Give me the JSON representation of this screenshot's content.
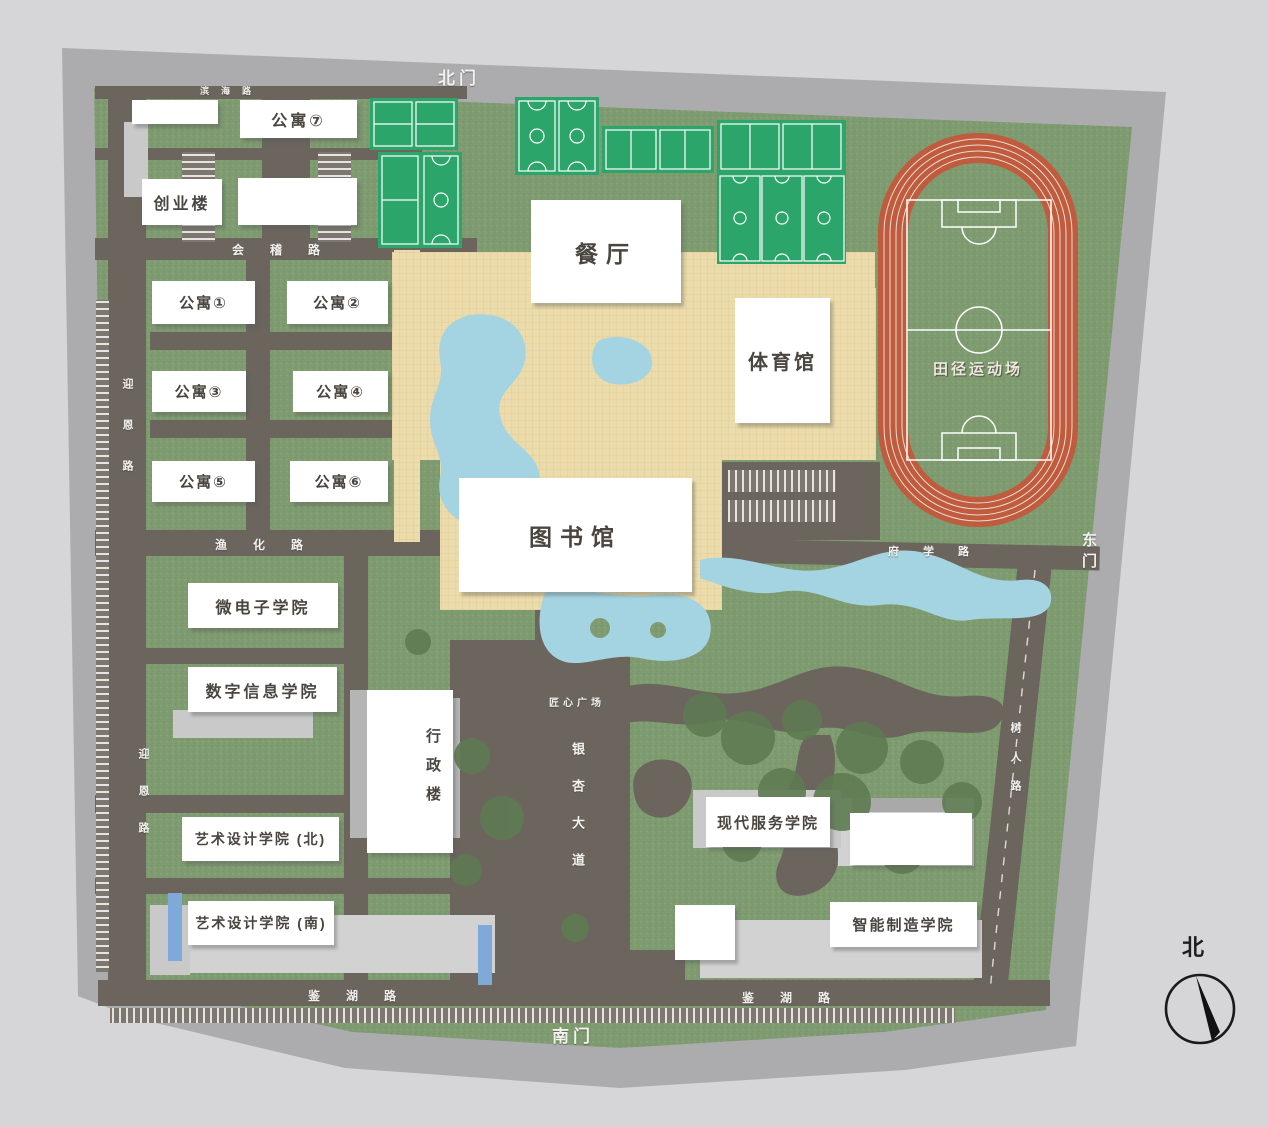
{
  "gates": {
    "north": "北门",
    "south": "南门",
    "east": "东门"
  },
  "roads": {
    "binhai": "滨海路",
    "huiji": "会稽路",
    "yuhua": "渔化路",
    "yingen": "迎恩路",
    "fuxue": "府学路",
    "shuren": "树人路",
    "jianhu": "鉴湖路",
    "yinxing_avenue": "银杏大道",
    "jiangxin_plaza": "匠心广场"
  },
  "buildings": {
    "gongyu1": "公寓①",
    "gongyu2": "公寓②",
    "gongyu3": "公寓③",
    "gongyu4": "公寓④",
    "gongyu5": "公寓⑤",
    "gongyu6": "公寓⑥",
    "gongyu7": "公寓⑦",
    "chuangye": "创业楼",
    "canting": "餐厅",
    "tiyuguan": "体育馆",
    "tushuguan": "图书馆",
    "xingzheng": "行政楼",
    "weidianzi": "微电子学院",
    "shuzi": "数字信息学院",
    "yishubei": "艺术设计学院 (北)",
    "yishunan": "艺术设计学院 (南)",
    "xiandai": "现代服务学院",
    "zhineng": "智能制造学院"
  },
  "facility": {
    "tianjing": "田径运动场"
  },
  "compass": {
    "north": "北"
  },
  "colors": {
    "background": "#d6d6d8",
    "ring_road": "#acacae",
    "grass": "#7f9c71",
    "inner_road": "#6b655e",
    "plaza": "#ecdcab",
    "water": "#a4d4e1",
    "court_green": "#2ca56b",
    "track_orange": "#c05b3d",
    "building_white": "#ffffff"
  }
}
